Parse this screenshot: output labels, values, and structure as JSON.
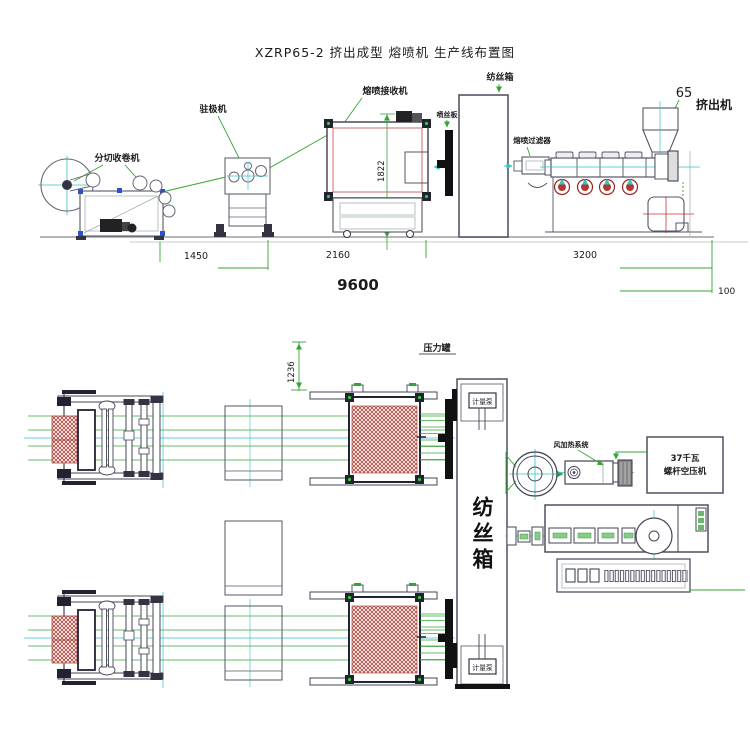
{
  "title": "XZRP65-2 挤出成型 熔喷机 生产线布置图",
  "side_view": {
    "labels": {
      "slitting_winder": "分切收卷机",
      "electret_machine": "驻极机",
      "meltblown_receiver": "熔喷接收机",
      "spinneret_plate": "喷丝板",
      "spinning_box": "纺丝箱",
      "melt_filter": "熔喷过滤器",
      "extruder_model": "65",
      "extruder": "挤出机"
    },
    "dimensions": {
      "receiver_height": "1822",
      "winder_span": "1450",
      "receiver_span": "2160",
      "extruder_span": "3200",
      "total_length": "9600",
      "edge_gap": "100"
    }
  },
  "plan_view": {
    "labels": {
      "pressure_tank": "压力罐",
      "metering_pump_upper": "计量泵",
      "metering_pump_lower": "计量泵",
      "spinning_box": "纺丝箱",
      "air_heating_system": "风加热系统",
      "air_compressor_line1": "37千瓦",
      "air_compressor_line2": "螺杆空压机"
    },
    "dimensions": {
      "box_offset": "1236"
    }
  },
  "colors": {
    "line_dark": "#3f3f52",
    "accent_green": "#35a535",
    "accent_cyan": "#33c2c6",
    "hatch_red": "#b04a40",
    "blue_block": "#2a4fd0",
    "fan_red": "#b03a30"
  }
}
